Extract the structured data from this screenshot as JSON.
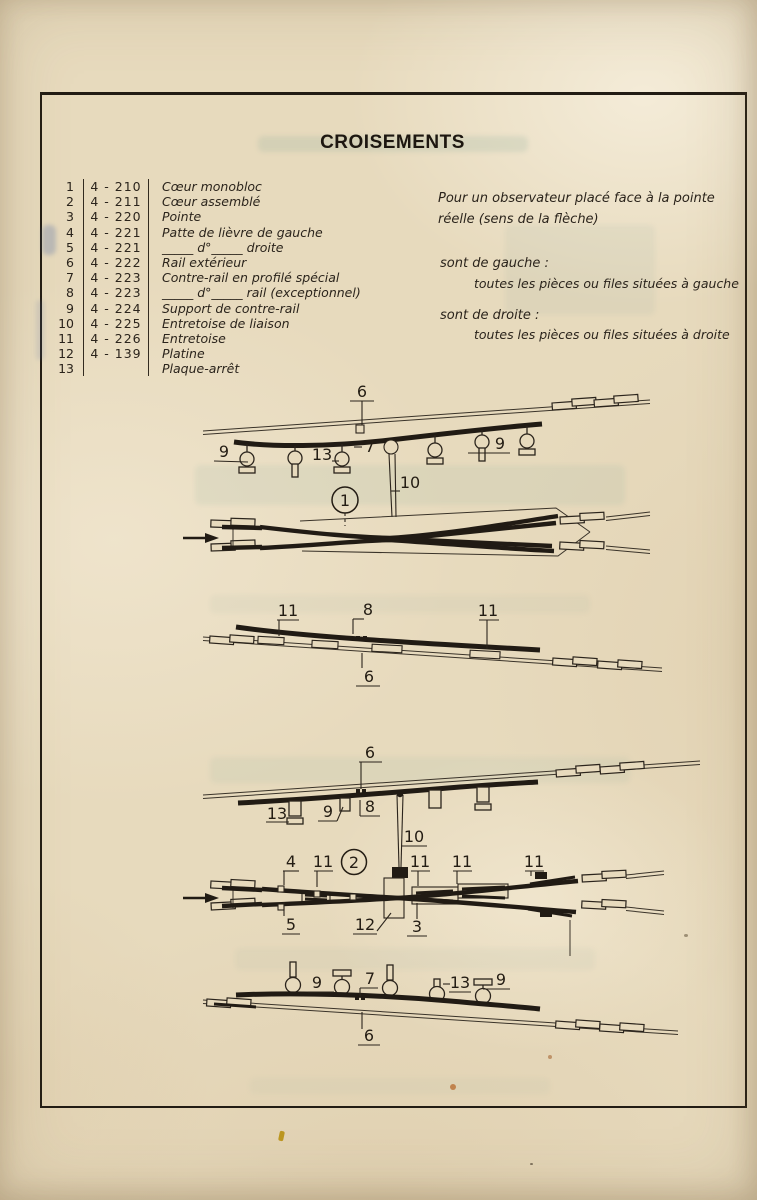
{
  "title": "CROISEMENTS",
  "parts": {
    "rows": [
      {
        "num": "1",
        "code": "4 - 210",
        "label": "Cœur monobloc"
      },
      {
        "num": "2",
        "code": "4 - 211",
        "label": "Cœur assemblé"
      },
      {
        "num": "3",
        "code": "4 - 220",
        "label": "Pointe"
      },
      {
        "num": "4",
        "code": "4 - 221",
        "label": "Patte de lièvre de gauche"
      },
      {
        "num": "5",
        "code": "4 - 221",
        "label": "_____ d°_____ droite"
      },
      {
        "num": "6",
        "code": "4 - 222",
        "label": "Rail extérieur"
      },
      {
        "num": "7",
        "code": "4 - 223",
        "label": "Contre-rail en profilé spécial"
      },
      {
        "num": "8",
        "code": "4 - 223",
        "label": "_____ d°_____ rail (exceptionnel)"
      },
      {
        "num": "9",
        "code": "4 - 224",
        "label": "Support de contre-rail"
      },
      {
        "num": "10",
        "code": "4 - 225",
        "label": "Entretoise de liaison"
      },
      {
        "num": "11",
        "code": "4 - 226",
        "label": "Entretoise"
      },
      {
        "num": "12",
        "code": "4 - 139",
        "label": "Platine"
      },
      {
        "num": "13",
        "code": "",
        "label": "Plaque-arrêt"
      }
    ]
  },
  "note": {
    "intro": "Pour un observateur placé face à la pointe réelle (sens de la flèche)",
    "left_heading": "sont de gauche :",
    "left_body": "toutes les pièces ou files situées à gauche",
    "right_heading": "sont de droite :",
    "right_body": "toutes les pièces ou files situées à droite"
  },
  "colors": {
    "paper": "#e7dabd",
    "ink": "#2b241c"
  },
  "d1": {
    "n6": "6",
    "n9a": "9",
    "n13": "13",
    "n7": "7",
    "n9b": "9",
    "n10": "10",
    "badge": "1"
  },
  "d2": {
    "n11a": "11",
    "n8": "8",
    "n11b": "11",
    "n6": "6"
  },
  "d3": {
    "n6": "6",
    "n13a": "13",
    "n9a": "9",
    "n8": "8",
    "n10": "10",
    "badge": "2",
    "n4": "4",
    "n11a": "11",
    "n11b": "11",
    "n11c": "11",
    "n11d": "11",
    "n5": "5",
    "n12": "12",
    "n3": "3",
    "n9b": "9",
    "n7": "7",
    "n13b": "13",
    "n9c": "9",
    "n6b": "6"
  }
}
